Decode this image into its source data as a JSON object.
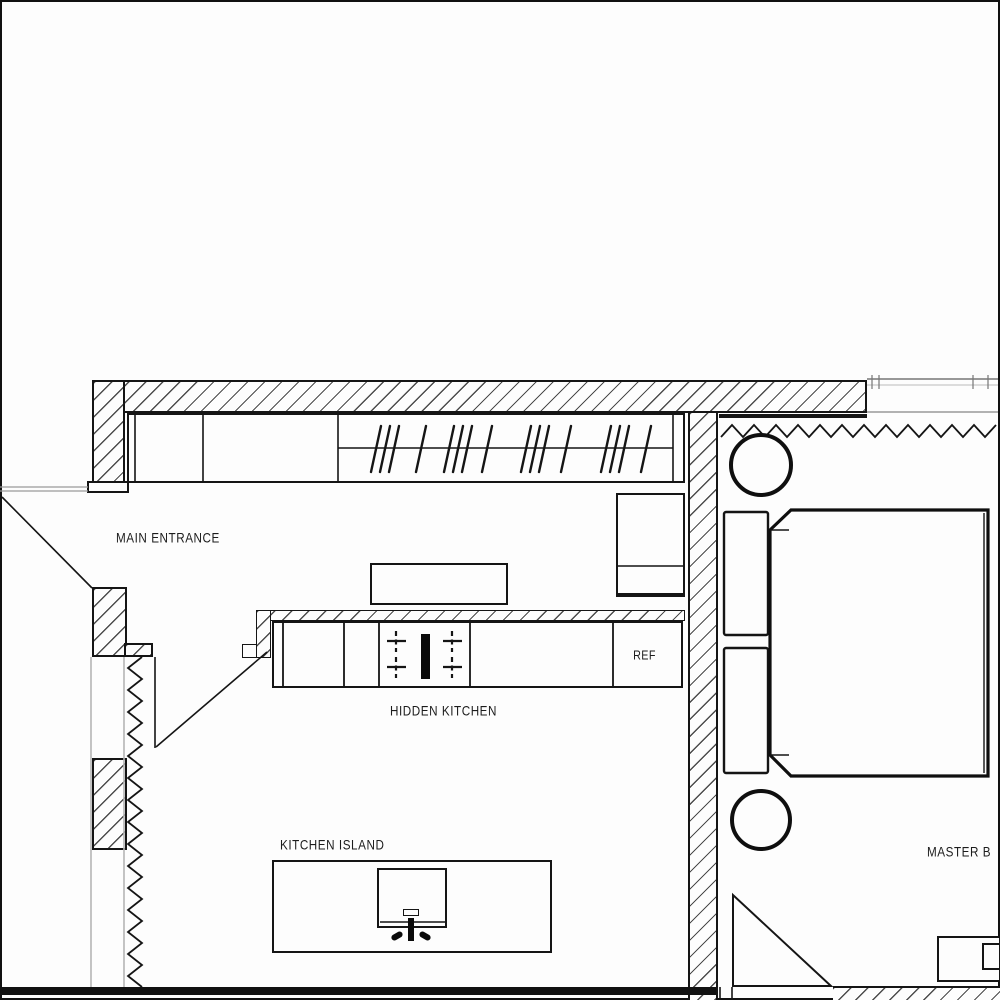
{
  "drawing": {
    "type": "architectural-floor-plan",
    "labels": {
      "main_entrance": "MAIN ENTRANCE",
      "hidden_kitchen": "HIDDEN KITCHEN",
      "kitchen_island": "KITCHEN ISLAND",
      "refrigerator": "REF",
      "master_bedroom": "MASTER B"
    },
    "fixtures": [
      "wardrobe-with-hangers",
      "tall-cabinet",
      "bench",
      "kitchen-counter",
      "cooktop",
      "refrigerator",
      "kitchen-island-sink",
      "bed-with-pillows",
      "round-side-table-top",
      "round-side-table-bottom",
      "console",
      "entry-door-swing",
      "kitchen-door-swing",
      "bedroom-door-swing",
      "curtain-left",
      "curtain-top"
    ],
    "colors": {
      "line": "#151515",
      "hatch": "#2d2d2d",
      "glazing": "#b5b5b5",
      "window_line": "#8a8a8a",
      "paper": "#fdfdfd"
    }
  }
}
